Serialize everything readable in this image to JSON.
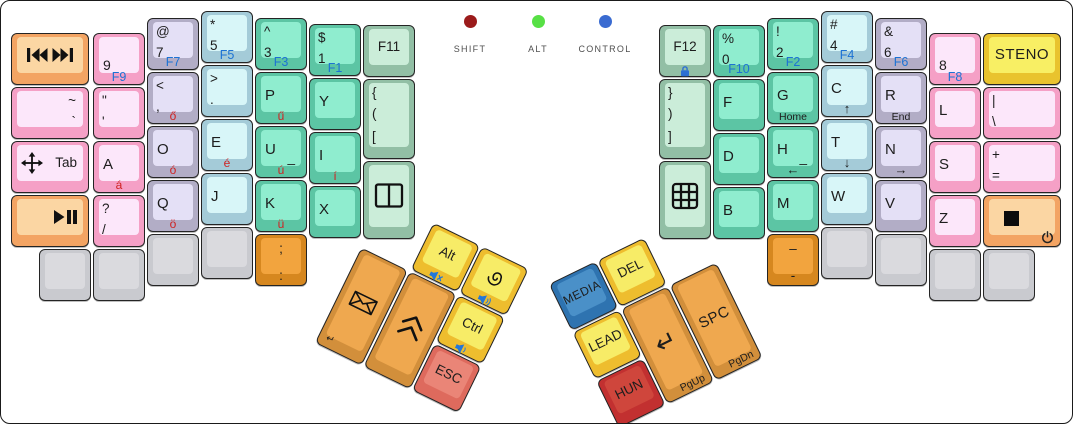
{
  "window": {
    "width": 1071,
    "height": 422
  },
  "palette": {
    "pink": {
      "base": "#f5a0c6",
      "top": "#fce7fa"
    },
    "lavender": {
      "base": "#b2adc6",
      "top": "#e4e0f6"
    },
    "cyan": {
      "base": "#a4cbd8",
      "top": "#d8f6f8"
    },
    "teal": {
      "base": "#5cc5a4",
      "top": "#8fedcf"
    },
    "mint": {
      "base": "#92bfa5",
      "top": "#cbedd9"
    },
    "peach": {
      "base": "#f3a463",
      "top": "#fbd6a3"
    },
    "gray": {
      "base": "#c9cacf",
      "top": "#dadade"
    },
    "yellow": {
      "base": "#e9c32e",
      "top": "#f8ef64"
    },
    "thumbyellow": {
      "base": "#eebd2e",
      "top": "#f7ec67"
    },
    "orange": {
      "base": "#d28f3b",
      "top": "#efa84f"
    },
    "darkorange": {
      "base": "#d6871f",
      "top": "#f2a43e"
    },
    "red": {
      "base": "#de6a5d",
      "top": "#ea8577"
    },
    "crimson": {
      "base": "#c23030",
      "top": "#cf463c"
    },
    "blue": {
      "base": "#2e73b0",
      "top": "#4a90c8"
    }
  },
  "ui": {
    "fn_label_color": "#1c72d4",
    "accent_letter_color": "#cf2222"
  },
  "indicators": [
    {
      "name": "shift",
      "label": "SHIFT",
      "color": "#9b1b1b",
      "x": 427,
      "y": 14
    },
    {
      "name": "alt",
      "label": "ALT",
      "color": "#57e045",
      "x": 495,
      "y": 14
    },
    {
      "name": "control",
      "label": "CONTROL",
      "color": "#3a6bd1",
      "x": 562,
      "y": 14
    }
  ],
  "keys": [
    {
      "n": "media-prev-next",
      "x": 10,
      "y": 32,
      "w": 78,
      "c": "peach",
      "ic": [
        {
          "i": "media-prev-next-icon",
          "p": "c"
        }
      ]
    },
    {
      "n": "tilde-backtick",
      "x": 10,
      "y": 86,
      "w": 78,
      "c": "pink",
      "ls": [
        {
          "t": "~",
          "p": "tr"
        },
        {
          "t": "`",
          "p": "2r"
        }
      ]
    },
    {
      "n": "tab",
      "x": 10,
      "y": 140,
      "w": 78,
      "c": "pink",
      "ls": [
        {
          "t": "Tab",
          "p": "cr"
        }
      ],
      "ic": [
        {
          "i": "move-icon",
          "p": "cl"
        }
      ]
    },
    {
      "n": "play-pause",
      "x": 10,
      "y": 194,
      "w": 78,
      "c": "peach",
      "ic": [
        {
          "i": "play-pause-icon",
          "p": "cr"
        }
      ]
    },
    {
      "n": "9",
      "x": 92,
      "y": 32,
      "c": "pink",
      "ls": [
        {
          "t": "9",
          "p": "ll"
        },
        {
          "t": "F9",
          "p": "bc",
          "s": "blue"
        }
      ]
    },
    {
      "n": "quote-apostrophe",
      "x": 92,
      "y": 86,
      "c": "pink",
      "ls": [
        {
          "t": "\"",
          "p": "tl"
        },
        {
          "t": "'",
          "p": "2l"
        }
      ]
    },
    {
      "n": "a",
      "x": 92,
      "y": 140,
      "c": "pink",
      "ls": [
        {
          "t": "A",
          "p": "ml"
        },
        {
          "t": "á",
          "p": "bc",
          "s": "red"
        }
      ]
    },
    {
      "n": "question-slash",
      "x": 92,
      "y": 194,
      "c": "pink",
      "ls": [
        {
          "t": "?",
          "p": "tl"
        },
        {
          "t": "/",
          "p": "2l"
        }
      ]
    },
    {
      "n": "blank-left-1",
      "x": 38,
      "y": 248,
      "c": "gray"
    },
    {
      "n": "blank-left-2",
      "x": 92,
      "y": 248,
      "c": "gray"
    },
    {
      "n": "at-7",
      "x": 146,
      "y": 17,
      "c": "lavender",
      "ls": [
        {
          "t": "@",
          "p": "tl"
        },
        {
          "t": "7",
          "p": "2l"
        },
        {
          "t": "F7",
          "p": "bc",
          "s": "blue"
        }
      ]
    },
    {
      "n": "less-comma",
      "x": 146,
      "y": 71,
      "c": "lavender",
      "ls": [
        {
          "t": "<",
          "p": "tl"
        },
        {
          "t": ",",
          "p": "2l"
        },
        {
          "t": "ő",
          "p": "bc",
          "s": "red"
        }
      ]
    },
    {
      "n": "o",
      "x": 146,
      "y": 125,
      "c": "lavender",
      "ls": [
        {
          "t": "O",
          "p": "ml"
        },
        {
          "t": "ó",
          "p": "bc",
          "s": "red"
        }
      ]
    },
    {
      "n": "q",
      "x": 146,
      "y": 179,
      "c": "lavender",
      "ls": [
        {
          "t": "Q",
          "p": "ml"
        },
        {
          "t": "ö",
          "p": "bc",
          "s": "red"
        }
      ]
    },
    {
      "n": "blank-left-3",
      "x": 146,
      "y": 233,
      "c": "gray"
    },
    {
      "n": "star-5",
      "x": 200,
      "y": 10,
      "c": "cyan",
      "ls": [
        {
          "t": "*",
          "p": "tl"
        },
        {
          "t": "5",
          "p": "2l"
        },
        {
          "t": "F5",
          "p": "bc",
          "s": "blue"
        }
      ]
    },
    {
      "n": "greater-period",
      "x": 200,
      "y": 64,
      "c": "cyan",
      "ls": [
        {
          "t": ">",
          "p": "tl"
        },
        {
          "t": ".",
          "p": "2l"
        }
      ]
    },
    {
      "n": "e",
      "x": 200,
      "y": 118,
      "c": "cyan",
      "ls": [
        {
          "t": "E",
          "p": "ml"
        },
        {
          "t": "é",
          "p": "bc",
          "s": "red"
        }
      ]
    },
    {
      "n": "j",
      "x": 200,
      "y": 172,
      "c": "cyan",
      "ls": [
        {
          "t": "J",
          "p": "ml"
        }
      ]
    },
    {
      "n": "blank-left-4",
      "x": 200,
      "y": 226,
      "c": "gray"
    },
    {
      "n": "caret-3",
      "x": 254,
      "y": 17,
      "c": "teal",
      "ls": [
        {
          "t": "^",
          "p": "tl"
        },
        {
          "t": "3",
          "p": "2l"
        },
        {
          "t": "F3",
          "p": "bc",
          "s": "blue"
        }
      ]
    },
    {
      "n": "p",
      "x": 254,
      "y": 71,
      "c": "teal",
      "ls": [
        {
          "t": "P",
          "p": "ml"
        },
        {
          "t": "ű",
          "p": "bc",
          "s": "red"
        }
      ]
    },
    {
      "n": "u",
      "x": 254,
      "y": 125,
      "c": "teal",
      "ls": [
        {
          "t": "U",
          "p": "ml"
        },
        {
          "t": "_",
          "p": "mr"
        },
        {
          "t": "ú",
          "p": "bc",
          "s": "red"
        }
      ]
    },
    {
      "n": "k",
      "x": 254,
      "y": 179,
      "c": "teal",
      "ls": [
        {
          "t": "K",
          "p": "ml"
        },
        {
          "t": "ü",
          "p": "bc",
          "s": "red"
        }
      ]
    },
    {
      "n": "semicolon-colon",
      "x": 254,
      "y": 233,
      "c": "darkorange",
      "ls": [
        {
          "t": ";",
          "p": "tc"
        },
        {
          "t": ":",
          "p": "2c"
        }
      ]
    },
    {
      "n": "dollar-1",
      "x": 308,
      "y": 23,
      "c": "teal",
      "ls": [
        {
          "t": "$",
          "p": "tl"
        },
        {
          "t": "1",
          "p": "2l"
        },
        {
          "t": "F1",
          "p": "bc",
          "s": "blue"
        }
      ]
    },
    {
      "n": "y",
      "x": 308,
      "y": 77,
      "c": "teal",
      "ls": [
        {
          "t": "Y",
          "p": "ml"
        }
      ]
    },
    {
      "n": "i",
      "x": 308,
      "y": 131,
      "c": "teal",
      "ls": [
        {
          "t": "I",
          "p": "ml"
        },
        {
          "t": "í",
          "p": "bc",
          "s": "red"
        }
      ]
    },
    {
      "n": "x",
      "x": 308,
      "y": 185,
      "c": "teal",
      "ls": [
        {
          "t": "X",
          "p": "ml"
        }
      ]
    },
    {
      "n": "f11",
      "x": 362,
      "y": 24,
      "c": "mint",
      "ls": [
        {
          "t": "F11",
          "p": "c"
        }
      ]
    },
    {
      "n": "open-brackets",
      "x": 362,
      "y": 78,
      "h": 80,
      "c": "mint",
      "ls": [
        {
          "t": "{",
          "p": "tl"
        },
        {
          "t": "(",
          "p": "2l"
        },
        {
          "t": "[",
          "p": "3l"
        }
      ]
    },
    {
      "n": "window-split",
      "x": 362,
      "y": 160,
      "h": 78,
      "c": "mint",
      "ic": [
        {
          "i": "vsplit-icon",
          "p": "c"
        }
      ]
    },
    {
      "n": "f12",
      "x": 658,
      "y": 24,
      "c": "mint",
      "ls": [
        {
          "t": "F12",
          "p": "c"
        }
      ],
      "ic": [
        {
          "i": "lock-icon",
          "p": "bc"
        }
      ]
    },
    {
      "n": "close-brackets",
      "x": 658,
      "y": 78,
      "h": 80,
      "c": "mint",
      "ls": [
        {
          "t": "}",
          "p": "tl"
        },
        {
          "t": ")",
          "p": "2l"
        },
        {
          "t": "]",
          "p": "3l"
        }
      ]
    },
    {
      "n": "grid",
      "x": 658,
      "y": 160,
      "h": 78,
      "c": "mint",
      "ic": [
        {
          "i": "grid-icon",
          "p": "c"
        }
      ]
    },
    {
      "n": "percent-0",
      "x": 712,
      "y": 24,
      "c": "teal",
      "ls": [
        {
          "t": "%",
          "p": "tl"
        },
        {
          "t": "0",
          "p": "2l"
        },
        {
          "t": "F10",
          "p": "bc",
          "s": "blue"
        }
      ]
    },
    {
      "n": "f",
      "x": 712,
      "y": 78,
      "c": "teal",
      "ls": [
        {
          "t": "F",
          "p": "ml"
        }
      ]
    },
    {
      "n": "d",
      "x": 712,
      "y": 132,
      "c": "teal",
      "ls": [
        {
          "t": "D",
          "p": "ml"
        }
      ]
    },
    {
      "n": "b",
      "x": 712,
      "y": 186,
      "c": "teal",
      "ls": [
        {
          "t": "B",
          "p": "ml"
        }
      ]
    },
    {
      "n": "exclam-2",
      "x": 766,
      "y": 17,
      "c": "teal",
      "ls": [
        {
          "t": "!",
          "p": "tl"
        },
        {
          "t": "2",
          "p": "2l"
        },
        {
          "t": "F2",
          "p": "bc",
          "s": "blue"
        }
      ]
    },
    {
      "n": "g",
      "x": 766,
      "y": 71,
      "c": "teal",
      "ls": [
        {
          "t": "G",
          "p": "ml"
        },
        {
          "t": "Home",
          "p": "bc",
          "s": "sm"
        }
      ]
    },
    {
      "n": "h",
      "x": 766,
      "y": 125,
      "c": "teal",
      "ls": [
        {
          "t": "H",
          "p": "ml"
        },
        {
          "t": "_",
          "p": "mr"
        },
        {
          "t": "←",
          "p": "bc",
          "s": "arrow"
        }
      ]
    },
    {
      "n": "m",
      "x": 766,
      "y": 179,
      "c": "teal",
      "ls": [
        {
          "t": "M",
          "p": "ml"
        }
      ]
    },
    {
      "n": "endash-hyphen",
      "x": 766,
      "y": 233,
      "c": "darkorange",
      "ls": [
        {
          "t": "–",
          "p": "tc"
        },
        {
          "t": "-",
          "p": "2c"
        }
      ]
    },
    {
      "n": "hash-4",
      "x": 820,
      "y": 10,
      "c": "cyan",
      "ls": [
        {
          "t": "#",
          "p": "tl"
        },
        {
          "t": "4",
          "p": "2l"
        },
        {
          "t": "F4",
          "p": "bc",
          "s": "blue"
        }
      ]
    },
    {
      "n": "c",
      "x": 820,
      "y": 64,
      "c": "cyan",
      "ls": [
        {
          "t": "C",
          "p": "ml"
        },
        {
          "t": "↑",
          "p": "bc",
          "s": "arrow"
        }
      ]
    },
    {
      "n": "t",
      "x": 820,
      "y": 118,
      "c": "cyan",
      "ls": [
        {
          "t": "T",
          "p": "ml"
        },
        {
          "t": "↓",
          "p": "bc",
          "s": "arrow"
        }
      ]
    },
    {
      "n": "w",
      "x": 820,
      "y": 172,
      "c": "cyan",
      "ls": [
        {
          "t": "W",
          "p": "ml"
        }
      ]
    },
    {
      "n": "blank-right-1",
      "x": 820,
      "y": 226,
      "c": "gray"
    },
    {
      "n": "amp-6",
      "x": 874,
      "y": 17,
      "c": "lavender",
      "ls": [
        {
          "t": "&",
          "p": "tl"
        },
        {
          "t": "6",
          "p": "2l"
        },
        {
          "t": "F6",
          "p": "bc",
          "s": "blue"
        }
      ]
    },
    {
      "n": "r",
      "x": 874,
      "y": 71,
      "c": "lavender",
      "ls": [
        {
          "t": "R",
          "p": "ml"
        },
        {
          "t": "End",
          "p": "bc",
          "s": "sm"
        }
      ]
    },
    {
      "n": "n",
      "x": 874,
      "y": 125,
      "c": "lavender",
      "ls": [
        {
          "t": "N",
          "p": "ml"
        },
        {
          "t": "→",
          "p": "bc",
          "s": "arrow"
        }
      ]
    },
    {
      "n": "v",
      "x": 874,
      "y": 179,
      "c": "lavender",
      "ls": [
        {
          "t": "V",
          "p": "ml"
        }
      ]
    },
    {
      "n": "blank-right-2",
      "x": 874,
      "y": 233,
      "c": "gray"
    },
    {
      "n": "8",
      "x": 928,
      "y": 32,
      "c": "pink",
      "ls": [
        {
          "t": "8",
          "p": "ll"
        },
        {
          "t": "F8",
          "p": "bc",
          "s": "blue"
        }
      ]
    },
    {
      "n": "l",
      "x": 928,
      "y": 86,
      "c": "pink",
      "ls": [
        {
          "t": "L",
          "p": "ml"
        }
      ]
    },
    {
      "n": "s",
      "x": 928,
      "y": 140,
      "c": "pink",
      "ls": [
        {
          "t": "S",
          "p": "ml"
        }
      ]
    },
    {
      "n": "z",
      "x": 928,
      "y": 194,
      "c": "pink",
      "ls": [
        {
          "t": "Z",
          "p": "ml"
        }
      ]
    },
    {
      "n": "blank-right-3",
      "x": 928,
      "y": 248,
      "c": "gray"
    },
    {
      "n": "steno",
      "x": 982,
      "y": 32,
      "w": 78,
      "c": "yellow",
      "ls": [
        {
          "t": "STENO",
          "p": "c",
          "s": "steno"
        }
      ]
    },
    {
      "n": "pipe-backslash",
      "x": 982,
      "y": 86,
      "w": 78,
      "c": "pink",
      "ls": [
        {
          "t": "|",
          "p": "tl"
        },
        {
          "t": "\\",
          "p": "2l"
        }
      ]
    },
    {
      "n": "plus-equals",
      "x": 982,
      "y": 140,
      "w": 78,
      "c": "pink",
      "ls": [
        {
          "t": "+",
          "p": "tl"
        },
        {
          "t": "=",
          "p": "2l"
        }
      ]
    },
    {
      "n": "stop-power",
      "x": 982,
      "y": 194,
      "w": 78,
      "c": "peach",
      "ic": [
        {
          "i": "stop-icon",
          "p": "sq"
        },
        {
          "i": "power-icon",
          "p": "br"
        }
      ]
    },
    {
      "n": "blank-right-4",
      "x": 982,
      "y": 248,
      "c": "gray"
    }
  ],
  "thumb_clusters": [
    {
      "name": "left-thumb-cluster",
      "x": 384,
      "y": 198,
      "angle": 26,
      "keys": [
        {
          "n": "email",
          "x": 0,
          "y": 54,
          "h": 106,
          "c": "orange",
          "ls": [
            {
              "t": "↵",
              "p": "bl"
            }
          ],
          "ic": [
            {
              "i": "envelope-icon",
              "p": "c"
            }
          ]
        },
        {
          "n": "chevrons-up",
          "x": 54,
          "y": 54,
          "h": 106,
          "c": "orange",
          "ic": [
            {
              "i": "chevron-double-up-icon",
              "p": "c"
            }
          ]
        },
        {
          "n": "alt",
          "x": 54,
          "y": 0,
          "c": "thumbyellow",
          "ls": [
            {
              "t": "Alt",
              "p": "c"
            }
          ],
          "ic": [
            {
              "i": "mute-icon",
              "p": "bc"
            }
          ]
        },
        {
          "n": "swirl",
          "x": 108,
          "y": 0,
          "c": "thumbyellow",
          "ic": [
            {
              "i": "spiral-icon",
              "p": "c"
            },
            {
              "i": "volume-up-icon",
              "p": "bc"
            }
          ]
        },
        {
          "n": "ctrl",
          "x": 108,
          "y": 54,
          "c": "thumbyellow",
          "ls": [
            {
              "t": "Ctrl",
              "p": "c"
            }
          ],
          "ic": [
            {
              "i": "volume-down-icon",
              "p": "bc"
            }
          ]
        },
        {
          "n": "esc",
          "x": 108,
          "y": 108,
          "c": "red",
          "ls": [
            {
              "t": "ESC",
              "p": "c"
            }
          ]
        }
      ]
    },
    {
      "name": "right-thumb-cluster",
      "x": 546,
      "y": 284,
      "angle": -26,
      "keys": [
        {
          "n": "media",
          "x": 2,
          "y": 0,
          "c": "blue",
          "ls": [
            {
              "t": "MEDIA",
              "p": "c",
              "s": "media"
            }
          ]
        },
        {
          "n": "del",
          "x": 56,
          "y": 0,
          "c": "thumbyellow",
          "ls": [
            {
              "t": "DEL",
              "p": "c"
            }
          ]
        },
        {
          "n": "lead",
          "x": 2,
          "y": 54,
          "c": "thumbyellow",
          "ls": [
            {
              "t": "LEAD",
              "p": "c"
            }
          ]
        },
        {
          "n": "hun",
          "x": 2,
          "y": 108,
          "c": "crimson",
          "ls": [
            {
              "t": "HUN",
              "p": "c"
            }
          ]
        },
        {
          "n": "enter",
          "x": 56,
          "y": 54,
          "h": 106,
          "c": "orange",
          "ls": [
            {
              "t": "↵",
              "p": "c",
              "s": "enter"
            },
            {
              "t": "PgUp",
              "p": "br",
              "s": "sm"
            }
          ]
        },
        {
          "n": "spc",
          "x": 110,
          "y": 54,
          "h": 106,
          "c": "orange",
          "ls": [
            {
              "t": "SPC",
              "p": "c",
              "s": "spc"
            },
            {
              "t": "PgDn",
              "p": "br",
              "s": "sm"
            }
          ]
        }
      ]
    }
  ]
}
